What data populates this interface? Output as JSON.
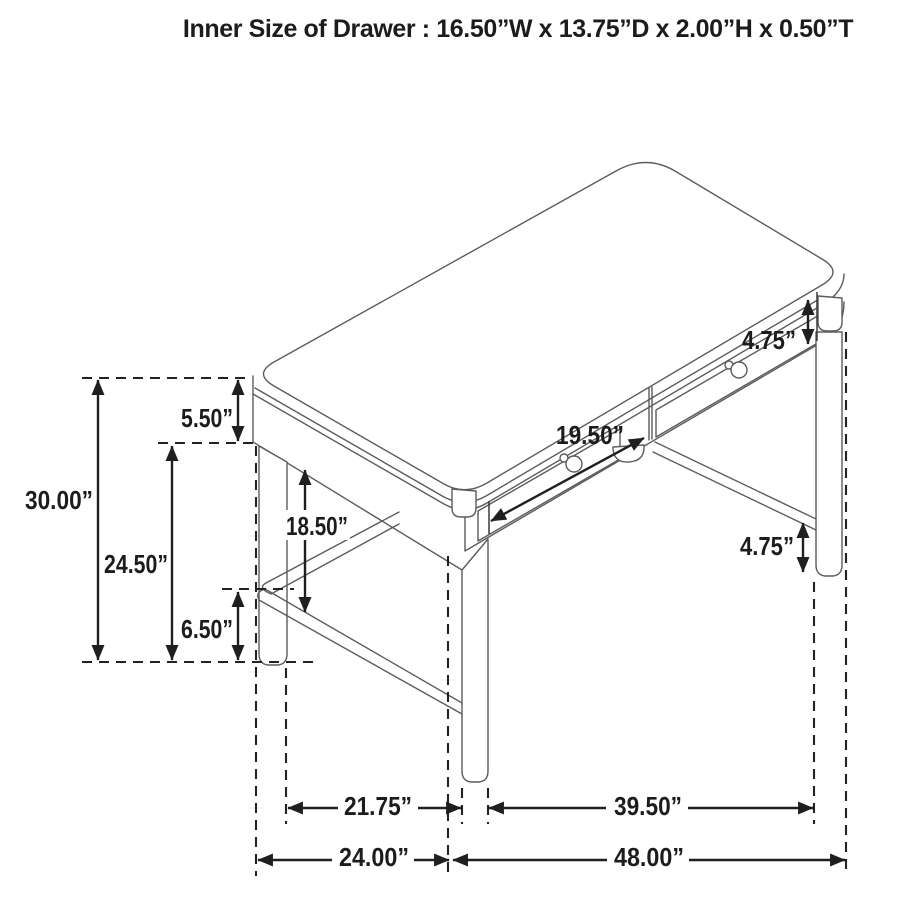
{
  "title": "Inner Size of Drawer : 16.50”W x 13.75”D x 2.00”H x 0.50”T",
  "dimensions": {
    "overall_height": "30.00”",
    "floor_to_side_apron": "24.50”",
    "side_apron_height": "5.50”",
    "stretcher_height": "6.50”",
    "leg_clear_height": "18.50”",
    "drawer_front_width": "19.50”",
    "front_apron_height": "4.75”",
    "leg_below_stretcher": "4.75”",
    "side_leg_span": "21.75”",
    "front_leg_span": "39.50”",
    "overall_depth": "24.00”",
    "overall_width": "48.00”"
  },
  "colors": {
    "background": "#ffffff",
    "artwork_line": "#5c5c5c",
    "dimension_line": "#1f1f1f",
    "text": "#1c1c1c"
  }
}
